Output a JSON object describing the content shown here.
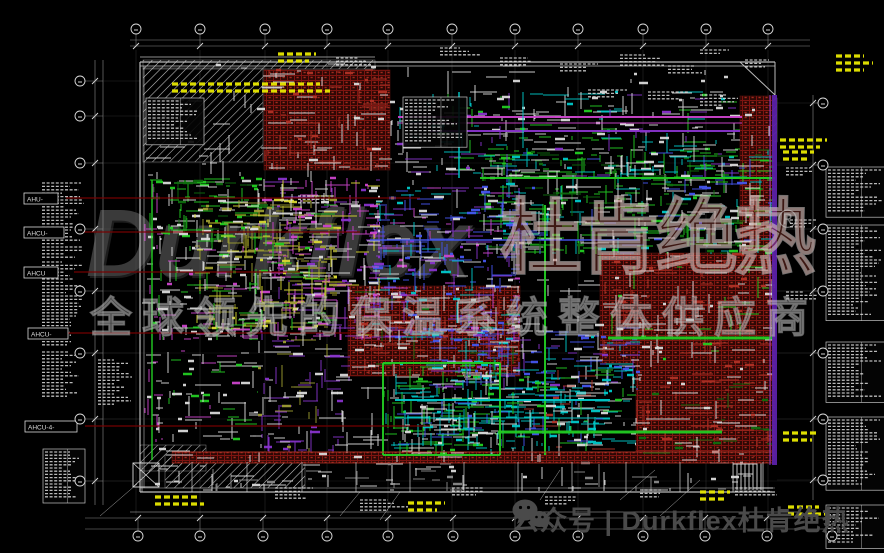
{
  "watermark": {
    "brand": "Durkflex",
    "brand_cn": "杜肯绝热",
    "registered": "®",
    "slogan": "全球领先的保温系统整体供应商"
  },
  "footer": {
    "wechat_icon": "wechat-icon",
    "text": "公众号 | Durkflex杜肯绝热"
  },
  "colors": {
    "white": "#DADADA",
    "gray": "#8A8A8A",
    "green": "#22CC22",
    "dgreen": "#0E6E0E",
    "cyan": "#00C8C8",
    "blue": "#4455EE",
    "purple": "#8833CC",
    "magenta": "#CC44CC",
    "yellow2": "#D8D830",
    "olive": "#9C9C30",
    "red2": "#B03226",
    "maroon": "#7A0000",
    "wallviolet": "#5B21A8",
    "outline": "#C4C4C4",
    "faint": "#555555",
    "rail": "#9A9A9A",
    "yellow": "#E8E800",
    "brickline": "#7E1410",
    "brickbg": "#2E0805",
    "brickdot": "#A22A1E"
  },
  "left_labels": [
    {
      "text": "AHU-",
      "x": 24,
      "y": 193,
      "w": 34
    },
    {
      "text": "AHCU-",
      "x": 24,
      "y": 227,
      "w": 40
    },
    {
      "text": "AHCU",
      "x": 24,
      "y": 267,
      "w": 34
    },
    {
      "text": "AHCU-",
      "x": 28,
      "y": 328,
      "w": 40
    },
    {
      "text": "AHCU-4-",
      "x": 25,
      "y": 421,
      "w": 52
    }
  ],
  "drawing": {
    "bubbles": {
      "top": {
        "y": 29,
        "xs": [
          136,
          200,
          265,
          327,
          388,
          452,
          515,
          578,
          643,
          706,
          768
        ]
      },
      "bottom": {
        "y": 536,
        "xs": [
          138,
          200,
          263,
          327,
          388,
          453,
          515,
          578,
          643,
          705,
          767,
          832
        ]
      },
      "left": {
        "x": 80,
        "ys": [
          81,
          116,
          163,
          229,
          291,
          353,
          419,
          481
        ]
      },
      "right": {
        "x": 823,
        "ys": [
          103,
          165,
          229,
          291,
          353,
          419,
          480
        ]
      }
    },
    "grid_ys": [
      163,
      229,
      291,
      353,
      419,
      481
    ],
    "rails": [
      [
        130,
        40,
        810,
        40
      ],
      [
        130,
        46,
        810,
        46
      ],
      [
        85,
        518,
        860,
        518
      ],
      [
        85,
        529,
        860,
        529
      ],
      [
        95,
        60,
        95,
        505
      ],
      [
        103,
        60,
        103,
        505
      ],
      [
        813,
        95,
        813,
        500
      ]
    ],
    "outline": [
      [
        140,
        62,
        775,
        62,
        1.2
      ],
      [
        140,
        66,
        775,
        66,
        0.7
      ],
      [
        140,
        62,
        140,
        492,
        1.2
      ],
      [
        144,
        66,
        144,
        488,
        0.6
      ],
      [
        775,
        62,
        775,
        95,
        1
      ],
      [
        140,
        492,
        775,
        492,
        1.2
      ],
      [
        140,
        488,
        775,
        488,
        0.6
      ],
      [
        740,
        62,
        775,
        95,
        1
      ],
      [
        140,
        57,
        375,
        57,
        0.8
      ],
      [
        130,
        512,
        800,
        512,
        0.5
      ]
    ],
    "hatches": [
      [
        143,
        68,
        120,
        94,
        "diag"
      ],
      [
        143,
        60,
        232,
        9,
        "diag"
      ],
      [
        140,
        445,
        66,
        26,
        "diag"
      ],
      [
        165,
        455,
        140,
        33,
        "diag"
      ],
      [
        746,
        98,
        22,
        60,
        "rungs"
      ],
      [
        733,
        462,
        30,
        28,
        "rungsv"
      ],
      [
        743,
        98,
        34,
        44,
        "diag"
      ]
    ],
    "bricks": [
      [
        264,
        70,
        126,
        100
      ],
      [
        348,
        286,
        172,
        90
      ],
      [
        600,
        253,
        175,
        110
      ],
      [
        636,
        362,
        139,
        95
      ],
      [
        740,
        96,
        33,
        156
      ],
      [
        172,
        452,
        601,
        11
      ]
    ],
    "zones": [
      [
        150,
        178,
        112,
        62,
        70,
        [
          "green",
          "white",
          "dgreen"
        ]
      ],
      [
        478,
        148,
        297,
        106,
        70,
        [
          "green",
          "white",
          "dgreen",
          "cyan",
          "blue"
        ]
      ],
      [
        383,
        363,
        118,
        92,
        70,
        [
          "green",
          "cyan",
          "white"
        ]
      ],
      [
        368,
        188,
        152,
        152,
        70,
        [
          "blue",
          "purple",
          "white",
          "cyan",
          "magenta"
        ]
      ],
      [
        428,
        328,
        212,
        62,
        70,
        [
          "blue",
          "cyan",
          "white",
          "purple"
        ]
      ],
      [
        392,
        388,
        218,
        58,
        75,
        [
          "cyan",
          "white",
          "blue"
        ]
      ],
      [
        258,
        178,
        122,
        162,
        70,
        [
          "magenta",
          "purple",
          "white",
          "yellow2"
        ]
      ],
      [
        195,
        200,
        142,
        130,
        70,
        [
          "olive",
          "yellow2",
          "white",
          "green"
        ]
      ],
      [
        395,
        92,
        345,
        85,
        130,
        [
          "white",
          "green",
          "cyan",
          "purple"
        ]
      ],
      [
        145,
        180,
        18,
        270,
        170,
        [
          "magenta",
          "white"
        ]
      ],
      [
        142,
        463,
        631,
        28,
        200,
        [
          "white",
          "gray"
        ]
      ],
      [
        348,
        286,
        172,
        90,
        170,
        [
          "red2",
          "white",
          "dgreen"
        ]
      ],
      [
        636,
        362,
        139,
        95,
        170,
        [
          "red2",
          "white",
          "dgreen"
        ]
      ],
      [
        264,
        70,
        126,
        100,
        190,
        [
          "red2",
          "white"
        ]
      ],
      [
        600,
        253,
        175,
        110,
        160,
        [
          "red2",
          "white",
          "green"
        ]
      ],
      [
        150,
        240,
        108,
        100,
        120,
        [
          "white",
          "magenta",
          "green"
        ]
      ],
      [
        500,
        363,
        136,
        88,
        110,
        [
          "cyan",
          "green",
          "white",
          "red2"
        ]
      ],
      [
        258,
        340,
        92,
        112,
        120,
        [
          "purple",
          "white",
          "olive"
        ]
      ],
      [
        142,
        350,
        116,
        92,
        180,
        [
          "white",
          "green",
          "magenta"
        ]
      ],
      [
        142,
        64,
        631,
        398,
        650,
        [
          "white"
        ]
      ]
    ],
    "pipes": [
      [
        608,
        338,
        775,
        338,
        "green",
        3
      ],
      [
        498,
        432,
        722,
        432,
        "green",
        3
      ],
      [
        383,
        363,
        383,
        455,
        "green",
        2
      ],
      [
        500,
        363,
        500,
        455,
        "green",
        2
      ],
      [
        383,
        363,
        500,
        363,
        "green",
        2
      ],
      [
        383,
        455,
        500,
        455,
        "green",
        2
      ],
      [
        545,
        205,
        545,
        455,
        "green",
        2
      ],
      [
        480,
        178,
        775,
        178,
        "green",
        2
      ],
      [
        152,
        180,
        152,
        460,
        "green",
        1.5
      ],
      [
        398,
        117,
        742,
        117,
        "magenta",
        2
      ],
      [
        398,
        123,
        742,
        123,
        "magenta",
        1
      ],
      [
        430,
        131,
        740,
        131,
        "purple",
        2
      ],
      [
        459,
        92,
        459,
        178,
        "cyan",
        1.5
      ],
      [
        523,
        92,
        523,
        148,
        "cyan",
        1
      ],
      [
        395,
        400,
        610,
        400,
        "cyan",
        2
      ],
      [
        395,
        418,
        610,
        418,
        "cyan",
        1
      ],
      [
        370,
        240,
        640,
        240,
        "blue",
        1.5
      ],
      [
        172,
        452,
        773,
        452,
        "red2",
        1
      ],
      [
        172,
        463,
        773,
        463,
        "red2",
        0.8
      ],
      [
        66,
        198,
        420,
        198,
        "maroon",
        1.2
      ],
      [
        80,
        232,
        360,
        232,
        "maroon",
        1.2
      ],
      [
        74,
        272,
        300,
        272,
        "maroon",
        1.2
      ],
      [
        68,
        333,
        380,
        333,
        "maroon",
        1.2
      ],
      [
        85,
        426,
        430,
        426,
        "maroon",
        1.2
      ]
    ],
    "textblocks": [
      [
        42,
        183,
        42,
        14,
        "white",
        0
      ],
      [
        42,
        230,
        42,
        9,
        "white",
        0
      ],
      [
        42,
        262,
        42,
        12,
        "white",
        0
      ],
      [
        42,
        300,
        42,
        15,
        "white",
        0
      ],
      [
        42,
        352,
        42,
        14,
        "white",
        0
      ],
      [
        98,
        360,
        34,
        14,
        "white",
        0
      ],
      [
        45,
        452,
        36,
        15,
        "white",
        1
      ],
      [
        148,
        101,
        52,
        12,
        "white",
        1
      ],
      [
        405,
        100,
        58,
        13,
        "white",
        1
      ],
      [
        828,
        170,
        54,
        13,
        "white",
        1
      ],
      [
        828,
        228,
        54,
        28,
        "white",
        1
      ],
      [
        828,
        345,
        54,
        17,
        "white",
        1
      ],
      [
        828,
        420,
        54,
        21,
        "white",
        1
      ],
      [
        828,
        508,
        54,
        11,
        "white",
        1
      ],
      [
        440,
        48,
        40,
        3,
        "white",
        0
      ],
      [
        500,
        58,
        42,
        3,
        "white",
        0
      ],
      [
        560,
        64,
        40,
        3,
        "white",
        0
      ],
      [
        620,
        55,
        45,
        4,
        "white",
        0
      ],
      [
        668,
        66,
        40,
        3,
        "white",
        0
      ],
      [
        700,
        50,
        40,
        2,
        "white",
        0
      ],
      [
        588,
        90,
        46,
        3,
        "white",
        0
      ],
      [
        648,
        92,
        40,
        3,
        "white",
        0
      ],
      [
        700,
        95,
        44,
        4,
        "white",
        0
      ],
      [
        745,
        60,
        30,
        3,
        "white",
        0
      ],
      [
        786,
        168,
        34,
        3,
        "white",
        0
      ],
      [
        786,
        292,
        34,
        3,
        "white",
        0
      ],
      [
        790,
        220,
        28,
        3,
        "white",
        0
      ],
      [
        275,
        488,
        46,
        4,
        "white",
        0
      ],
      [
        360,
        500,
        50,
        4,
        "white",
        0
      ],
      [
        452,
        488,
        42,
        3,
        "white",
        0
      ],
      [
        545,
        497,
        46,
        3,
        "white",
        0
      ],
      [
        640,
        490,
        40,
        3,
        "white",
        0
      ],
      [
        735,
        488,
        44,
        3,
        "white",
        0
      ],
      [
        298,
        196,
        40,
        3,
        "white",
        0
      ],
      [
        336,
        58,
        36,
        3,
        "white",
        0
      ]
    ],
    "yellowbars": [
      [
        172,
        84,
        168,
        2
      ],
      [
        278,
        54,
        44,
        2
      ],
      [
        836,
        56,
        46,
        3
      ],
      [
        780,
        140,
        50,
        2
      ],
      [
        783,
        152,
        32,
        2
      ],
      [
        783,
        433,
        42,
        2
      ],
      [
        155,
        497,
        50,
        2
      ],
      [
        408,
        503,
        40,
        2
      ],
      [
        700,
        492,
        36,
        2
      ],
      [
        788,
        507,
        40,
        2
      ]
    ],
    "diag_leaders": [
      [
        100,
        516,
        137,
        484
      ],
      [
        340,
        516,
        360,
        492
      ],
      [
        380,
        520,
        400,
        492
      ],
      [
        620,
        500,
        655,
        470
      ],
      [
        660,
        516,
        700,
        480
      ],
      [
        540,
        500,
        560,
        470
      ]
    ],
    "room_x": [
      142,
      192,
      247,
      302,
      356,
      410,
      464,
      518,
      572,
      626,
      680,
      733,
      763
    ],
    "rooms_y": [
      462,
      492
    ],
    "xbox": [
      133,
      463,
      26,
      24
    ],
    "wall": [
      772,
      95,
      5,
      370
    ]
  }
}
